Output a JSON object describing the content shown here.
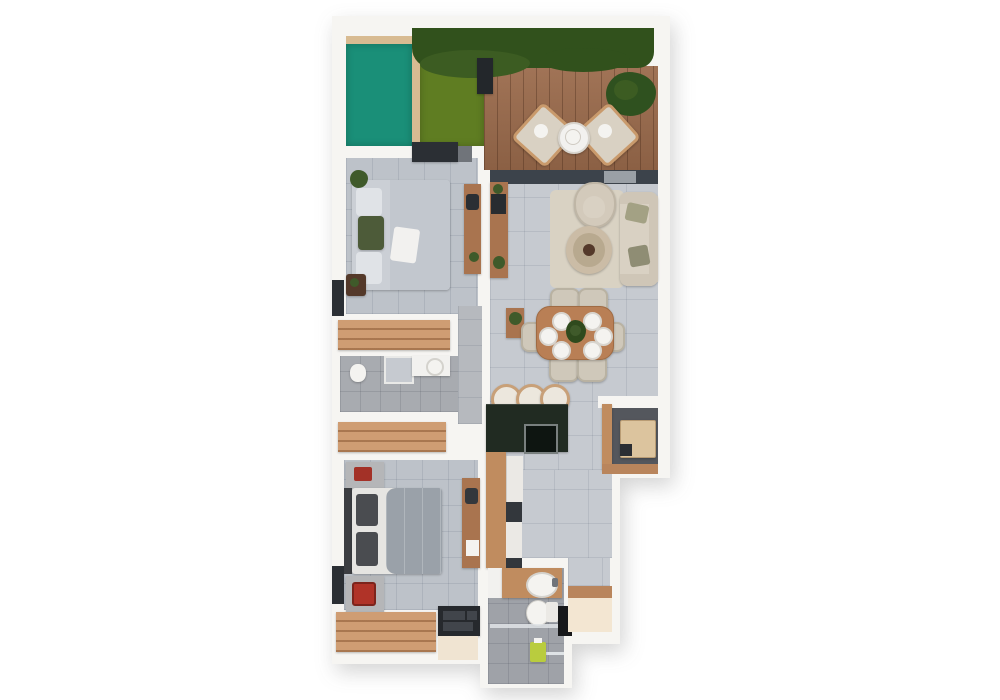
{
  "meta": {
    "scene": "apartment-floor-plan-top-view",
    "background": "#ffffff"
  },
  "legend": {
    "pool": "Pool",
    "garden": "Garden",
    "hedge": "Hedge",
    "terrace": "Terrace deck",
    "living": "Living room",
    "dining": "Dining area",
    "kitchen": "Kitchen",
    "corridor": "Corridor",
    "hallway": "Hallway",
    "bedroom1": "Bedroom 1",
    "bathroom1": "Bathroom 1",
    "bedroom2": "Bedroom 2",
    "bathroom2": "Bathroom 2",
    "utility": "Utility nook",
    "entry": "Entry"
  },
  "palette": {
    "wall": "#f6f5f2",
    "pool": "#1a8f78",
    "pool_rim": "#d8bb92",
    "grass": "#5f7d22",
    "hedge": "#31511c",
    "hedge_light": "#3c5c22",
    "deck": "#9b6b4c",
    "deck_plant": "#2f511f",
    "lamp_dark": "#23272b",
    "track": "#3c434b",
    "track_gap": "#9aa0a6",
    "tile_living": "#c6cad0",
    "tile_bedroom": "#bdc2c9",
    "tile_hall": "#b6b9be",
    "tile_bath": "#a8abb0",
    "tile_shower": "#9fa2a8",
    "wood": "#a9744f",
    "wood_dark": "#54392a",
    "wardrobe": "#cf9d73",
    "cabinet": "#c08c5f",
    "threshold": "#b9855c",
    "counter": "#212b22",
    "sink_dark": "#0e1511",
    "stool": "#ece7dd",
    "stool_ring": "#c8a078",
    "sofa": "#d9d1c3",
    "sofa_arm": "#cfc6b7",
    "rug": "#d9d2c3",
    "chair": "#cfc8ba",
    "armchair": "#d3cabb",
    "table_wood": "#b97f55",
    "coffee": "#cbbca6",
    "coffee_inner": "#b8a98f",
    "plate": "#f4f3f0",
    "plant": "#3f5a2a",
    "plant_dark": "#2f4a1d",
    "bed1": "#cbcfd5",
    "bed1_duvet": "#c2c7ce",
    "pillow": "#e0e3e7",
    "pillow_green": "#4d5b39",
    "bed2_base": "#e6e5e2",
    "bed2_duvet": "#9aa1a9",
    "bed2_pillow": "#4a4c50",
    "headboard": "#3c3e42",
    "nightstand": "#b5b6b8",
    "red": "#a33127",
    "red_bright": "#b03328",
    "dark": "#2b2f34",
    "gray_mid": "#70747a",
    "white_fix": "#f2f1ef",
    "appliance": "#ebe9e5",
    "appliance_dark": "#33373c",
    "utility_floor": "#54575d",
    "washer": "#dcc49e",
    "washer_dark": "#2b2e33",
    "entry_floor": "#f3e6d2",
    "beige_patch": "#f0e4d2",
    "glass": "#dfe3e6",
    "bottle": "#b9cc3e",
    "door_dark": "#17181a",
    "shelf_dark": "#26292d",
    "shelf_slot": "#41454b",
    "tv": "#282c30",
    "paper": "#f4f3f0",
    "olive_pillow": "#a3a184",
    "olive_pillow2": "#8f8d74"
  }
}
